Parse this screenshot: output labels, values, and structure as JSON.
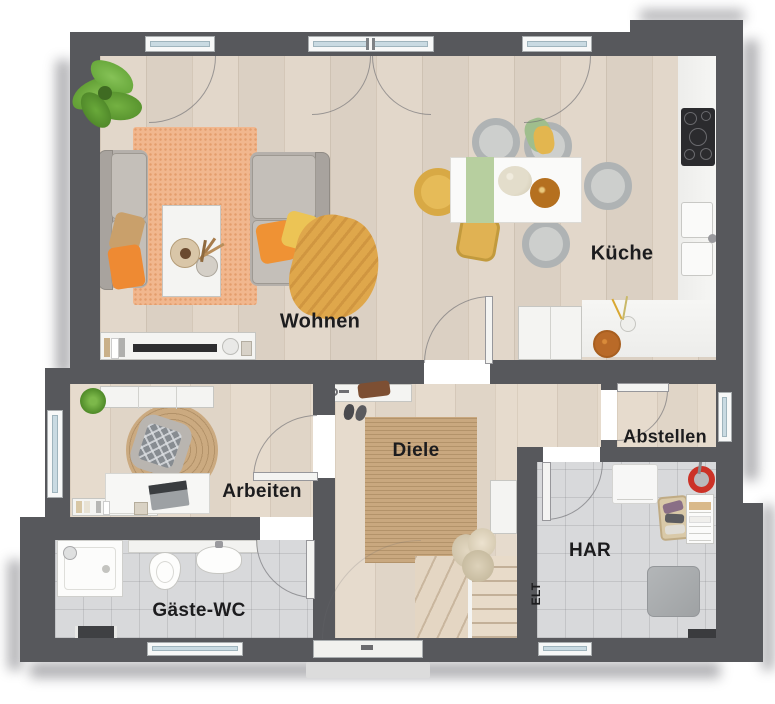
{
  "page": {
    "type": "floor-plan",
    "background": "#ffffff"
  },
  "rooms": [
    {
      "id": "wohnen",
      "label": "Wohnen"
    },
    {
      "id": "kueche",
      "label": "Küche"
    },
    {
      "id": "arbeiten",
      "label": "Arbeiten"
    },
    {
      "id": "diele",
      "label": "Diele"
    },
    {
      "id": "gaeste-wc",
      "label": "Gäste-WC"
    },
    {
      "id": "abstellen",
      "label": "Abstellen"
    },
    {
      "id": "har",
      "label": "HAR"
    },
    {
      "id": "elt",
      "label": "ELT"
    }
  ],
  "colors": {
    "wall": "#57585c",
    "wood_floor": "#dfd4c7",
    "tile_floor": "#d8d9db",
    "rug_orange": "#f1b78e",
    "rug_jute": "#c9a87f",
    "accent_orange": "#ee8a33",
    "accent_yellow": "#eec04f",
    "blanket_mustard": "#dfa74b",
    "plant_green": "#6fae3e",
    "window_glass": "#c9dae2",
    "counter_white": "#f3f3f1",
    "cooktop_black": "#2b2b2e"
  }
}
